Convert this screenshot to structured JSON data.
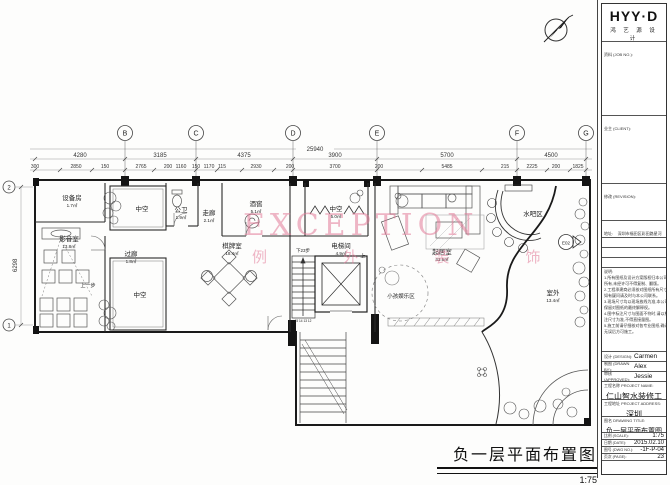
{
  "plan": {
    "grid": {
      "top_letters": [
        "B",
        "C",
        "D",
        "E",
        "F",
        "G"
      ],
      "left_numbers": [
        "2",
        "1"
      ]
    },
    "dims": {
      "overall": "25940",
      "left_overall": "6298",
      "row1": [
        "4280",
        "3185",
        "4375",
        "3900",
        "5700",
        "4500"
      ],
      "row2": [
        "300",
        "2850",
        "150",
        "2765",
        "200",
        "1160",
        "150",
        "1170",
        "115",
        "2930",
        "200",
        "3700",
        "200",
        "5485",
        "215",
        "2225",
        "200",
        "1825"
      ]
    },
    "rooms": [
      {
        "name": "设备房",
        "area": "1.7㎡"
      },
      {
        "name": "中空",
        "area": ""
      },
      {
        "name": "公卫",
        "area": "1.9㎡"
      },
      {
        "name": "走廊",
        "area": "2.1㎡"
      },
      {
        "name": "酒窖",
        "area": "5.1㎡"
      },
      {
        "name": "中空",
        "area": "5.0㎡"
      },
      {
        "name": "水吧区",
        "area": ""
      },
      {
        "name": "影音室",
        "area": "13.8㎡"
      },
      {
        "name": "过廊",
        "area": "1.8㎡"
      },
      {
        "name": "中空",
        "area": ""
      },
      {
        "name": "棋牌室",
        "area": "18.4㎡"
      },
      {
        "name": "电梯间",
        "area": "4.9㎡"
      },
      {
        "name": "起居室",
        "area": "43.6㎡"
      },
      {
        "name": "小孩娱乐区",
        "area": ""
      },
      {
        "name": "室外",
        "area": "13.4㎡"
      }
    ],
    "annotations": {
      "steps_up": "上一步",
      "steps_down": "下23步",
      "up": "上",
      "stair_numbers": "15 14 13 12",
      "elev_marker": "E02"
    },
    "watermark": {
      "line1": "EXCEPTION",
      "line2": "例 外 装 饰",
      "color": "#e27a98"
    }
  },
  "footer": {
    "title": "负一层平面布置图",
    "scale": "1:75"
  },
  "sidebar": {
    "logo": {
      "name": "HYY·D",
      "sub": "鸿 艺 源 设 计"
    },
    "sections": {
      "job": "资料 (JOB NO.):",
      "client": "业主 (CLIENT):",
      "revision": "修改 (REVISION):"
    },
    "contact": {
      "address_label": "地址:",
      "address": "深圳市福田区彩田路星河世纪大厦23楼",
      "tel_label": "电话 (Tel):",
      "tel": "0755-82793086",
      "fax_label": "传真 (Fax):",
      "fax": "0755-82793085",
      "mail_label": "邮箱 (Mail):",
      "mail": "www.hyydesign.com"
    },
    "notes_label": "说明:",
    "notes": [
      "1.所有图纸及设计方案版权归本公司",
      "所有,未经许可不得复制、翻版。",
      "2.工程承建商必须核对图纸所有尺寸,",
      "如有疑问请及时与本公司联系。",
      "3.现场尺寸均以现场放线为准,本公司",
      "保留对图纸的最终解释权。",
      "4.图中标注尺寸与图面不符时,请以标",
      "注尺寸为准,不得直接量图。",
      "5.施工前请仔细核对各专业图纸,确认",
      "无误后方可施工。"
    ],
    "people": [
      {
        "label": "设计 (DESIGN):",
        "value": "Carmen"
      },
      {
        "label": "制图 (DRAWN BY):",
        "value": "Alex"
      },
      {
        "label": "审核 (APPROVED):",
        "value": "Jessie"
      }
    ],
    "project_name_label": "工程名称 PROJECT NAME:",
    "project_name": "仁山智水装修工程",
    "project_addr_label": "工程地址 PROJECT ADDRESS:",
    "project_addr": "深圳",
    "drawing_title_label": "图名 DRAWING TITLE:",
    "drawing_title": "负一层平面布置图",
    "meta": [
      {
        "label": "比例 (SCALE):",
        "value": "1:75"
      },
      {
        "label": "日期 (DATE):",
        "value": "2015.02.10"
      },
      {
        "label": "图号 (DWG NO.):",
        "value": "-1F-P-04"
      },
      {
        "label": "页次 (PAGE):",
        "value": "23"
      }
    ]
  }
}
